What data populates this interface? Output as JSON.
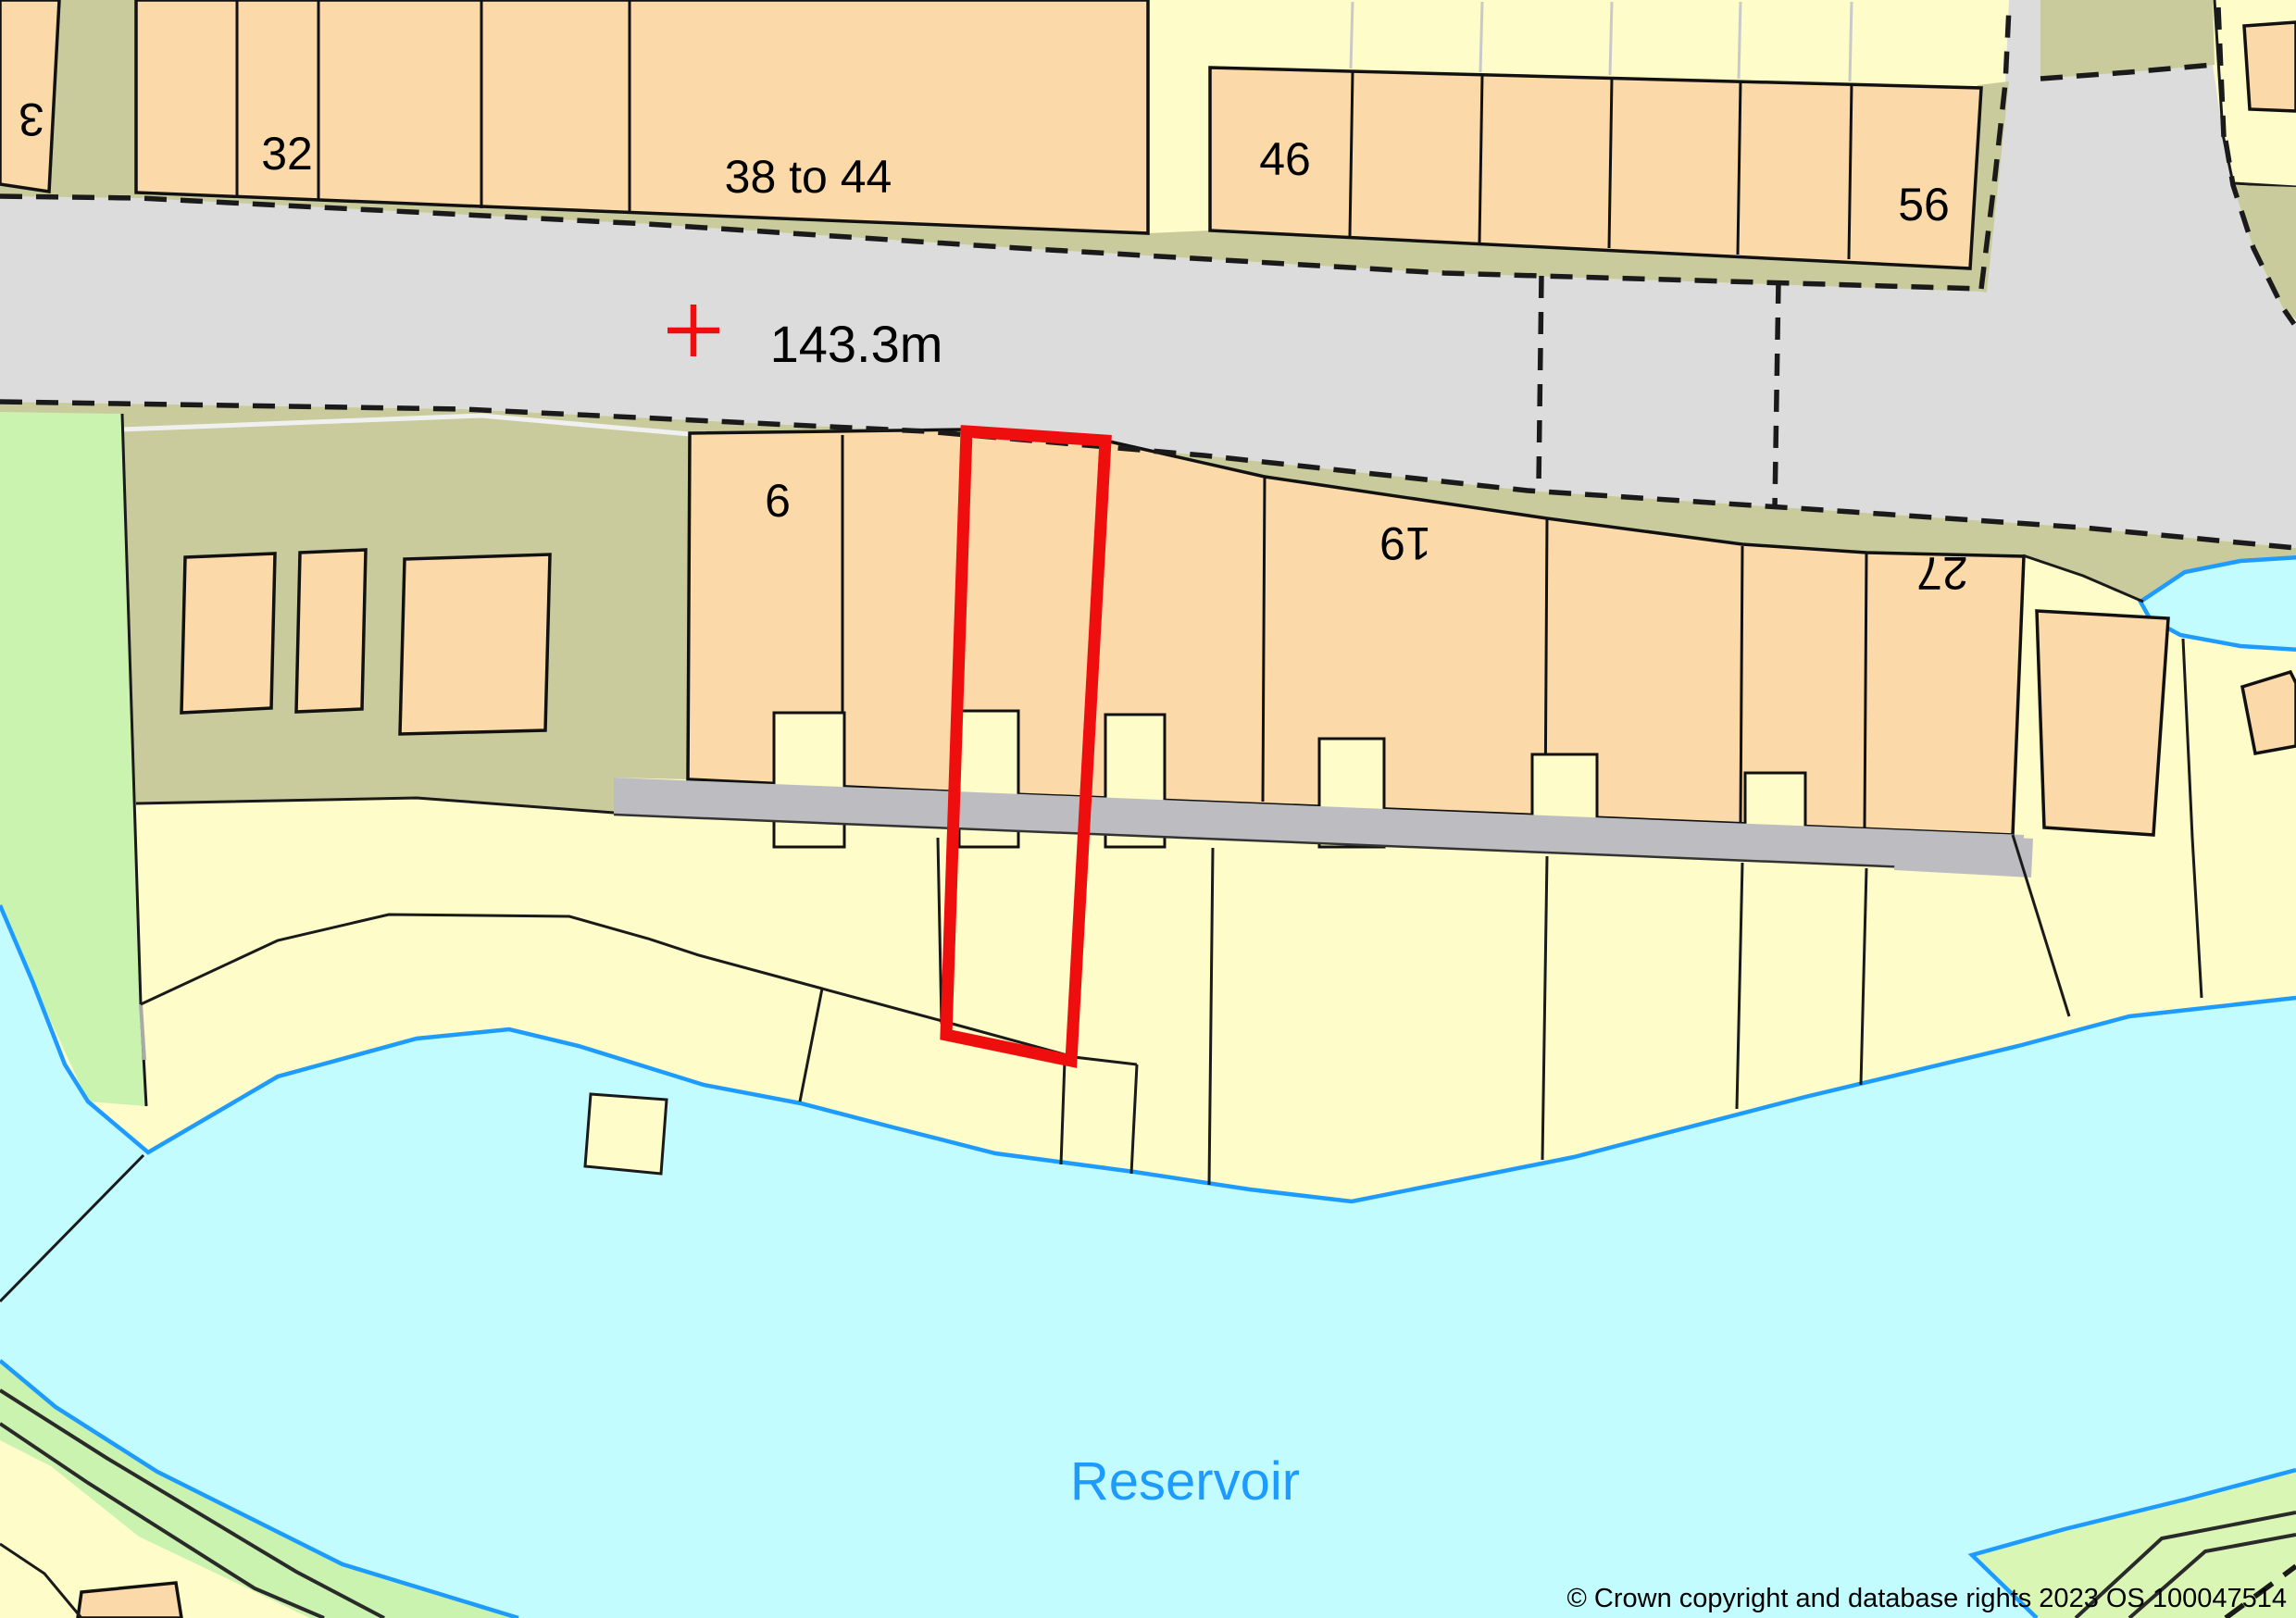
{
  "map": {
    "labels": {
      "building_3": "3",
      "building_32": "32",
      "building_38_44": "38 to 44",
      "building_46": "46",
      "building_56": "56",
      "building_6": "6",
      "building_19": "19",
      "building_27": "27",
      "spot_height": "143.3m",
      "water_name": "Reservoir",
      "copyright": "© Crown copyright and database rights 2023 OS 100047514"
    },
    "colors": {
      "building": "#FBD9A8",
      "parcel": "#FEFCC8",
      "verge": "#C9CB9C",
      "green": "#C9F3AE",
      "green_corner": "#DAF6B4",
      "road": "#DCDCDC",
      "path": "#BDBDC1",
      "water_fill": "#C3FCFF",
      "water_line": "#1E9BFF",
      "highlight": "#EE0E0E",
      "label_text": "#000000"
    }
  }
}
